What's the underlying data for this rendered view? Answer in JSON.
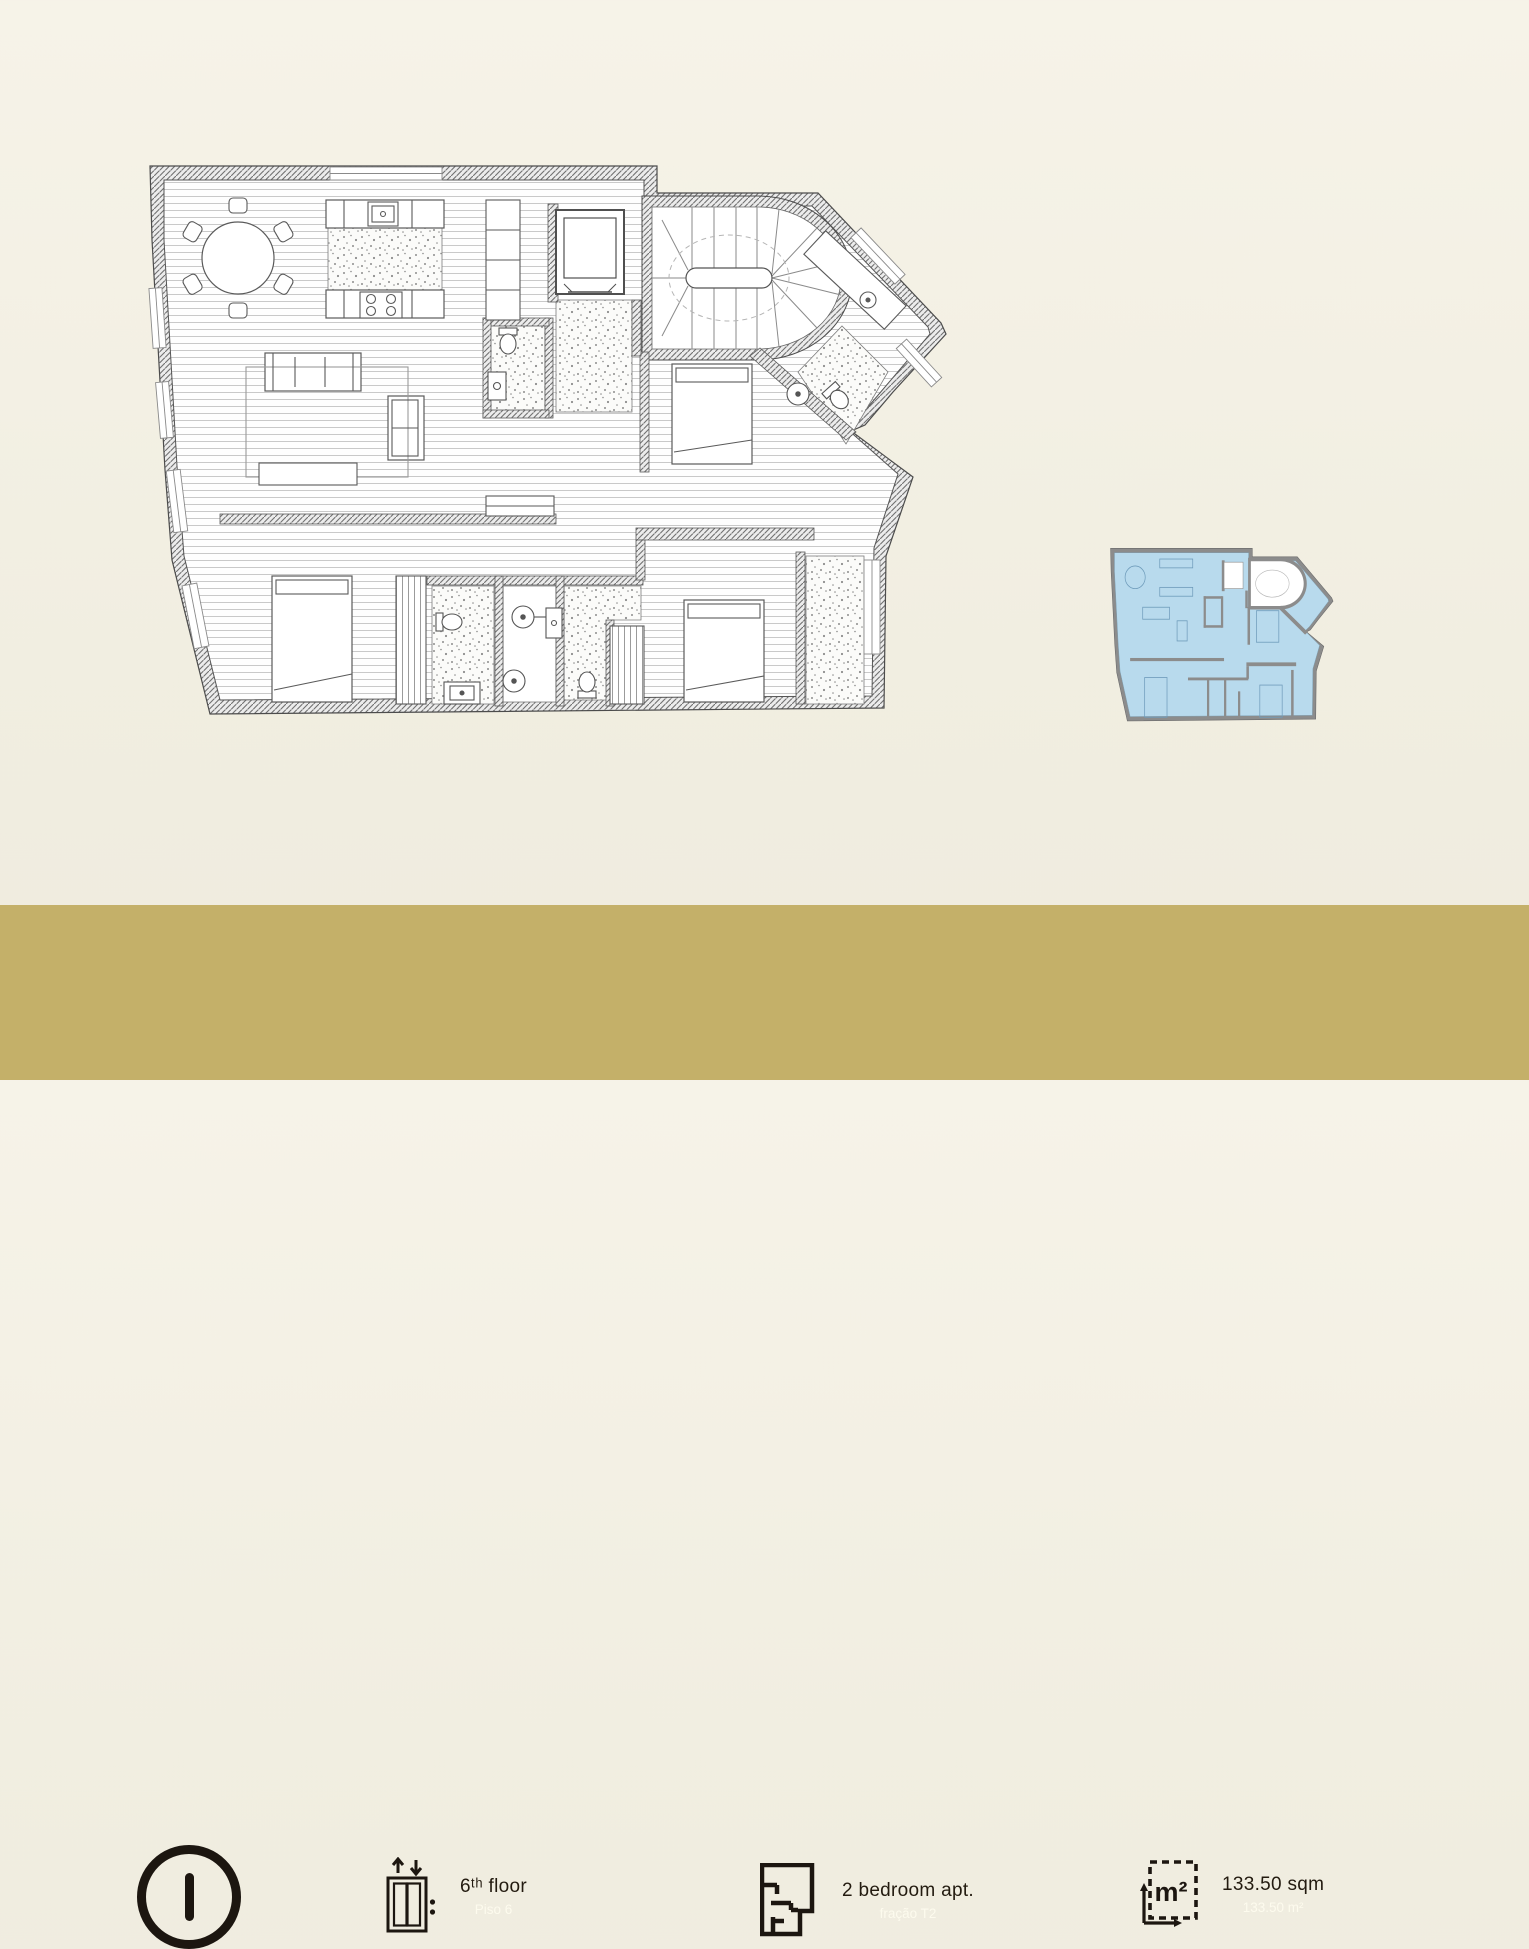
{
  "footer": {
    "marker": "I",
    "floor": {
      "label": "6ᵗʰ floor",
      "sublabel": "Piso 6"
    },
    "apartment": {
      "label": "2 bedroom apt.",
      "sublabel": "fração T2"
    },
    "area": {
      "label": "133.50 sqm",
      "sublabel": "133.50 m²",
      "unit": "m²"
    },
    "icons": {
      "marker": "letter-i-circle",
      "floor": "elevator-icon",
      "apartment": "floorplan-icon",
      "area": "area-measure-icon"
    }
  },
  "colors": {
    "background": "#f2efe2",
    "footer_bar": "#c4b069",
    "ink_dark": "#1c1610",
    "ink_light": "#fdfbee",
    "plan_wall": "#6f6f6f",
    "miniplan_highlight": "#b8daed"
  }
}
